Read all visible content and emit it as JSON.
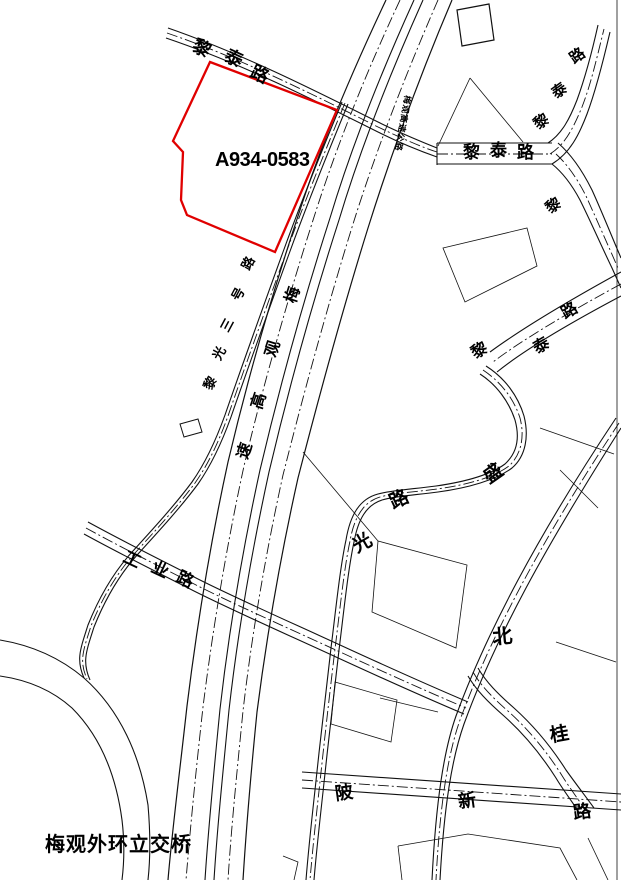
{
  "parcel": {
    "id": "A934-0583",
    "outline_color": "#e00000"
  },
  "caption": {
    "bridge": "梅观外环立交桥"
  },
  "road_names": {
    "litai": "黎泰路",
    "gongye": "工业路",
    "poxin": "陂新路",
    "liguang": "黎光三号路",
    "expressway": "梅观高速"
  },
  "labels": {
    "litai_nw": [
      "黎",
      "泰",
      "路"
    ],
    "litai_h": [
      "黎",
      "泰",
      "路"
    ],
    "litai_ne": [
      "路",
      "泰",
      "黎"
    ],
    "li_single": "黎",
    "litai_mid": [
      "黎",
      "泰",
      "路"
    ],
    "sheng": "盛",
    "lu_mid": "路",
    "guang": "光",
    "bei": "北",
    "gui": "桂",
    "poxin": [
      "陂",
      "新",
      "路"
    ],
    "gongye": [
      "工",
      "业",
      "路"
    ],
    "liguang": [
      "路",
      "号",
      "三",
      "光",
      "黎"
    ],
    "expressway_median": [
      "梅",
      "观",
      "高",
      "速"
    ],
    "expressway_small": "梅观高速公路"
  }
}
